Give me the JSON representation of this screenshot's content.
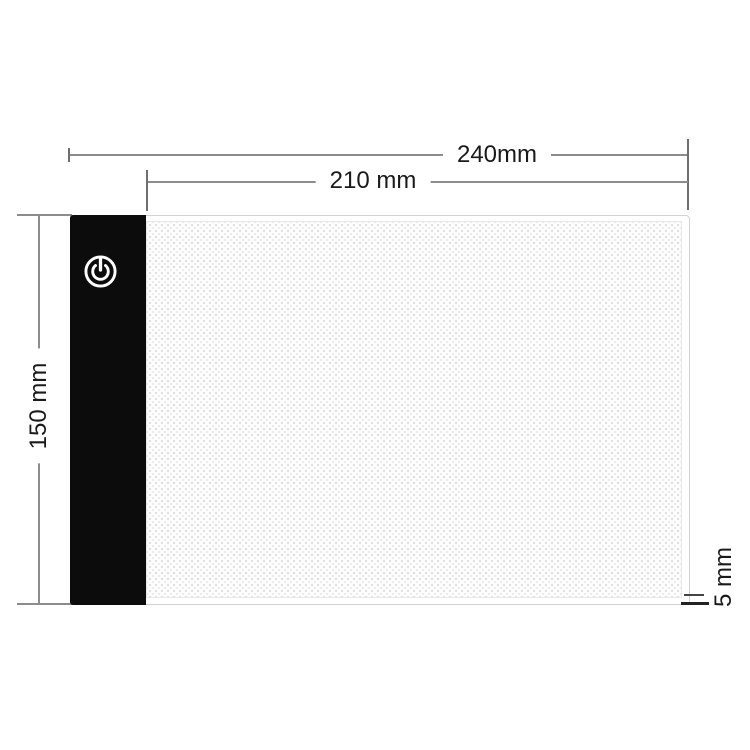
{
  "diagram": {
    "title": "light-pad-dimension-diagram",
    "dimensions": {
      "overall_width": {
        "value": 240,
        "unit": "mm",
        "label": "240mm"
      },
      "surface_width": {
        "value": 210,
        "unit": "mm",
        "label": "210 mm"
      },
      "height": {
        "value": 150,
        "unit": "mm",
        "label": "150 mm"
      },
      "thickness": {
        "value": 5,
        "unit": "mm",
        "label": "5 mm"
      }
    },
    "icons": {
      "power": "power-icon"
    },
    "colors": {
      "background": "#ffffff",
      "strip": "#0c0c0c",
      "icon": "#ffffff",
      "dimension_line": "#8c8c8c",
      "text": "#1a1a1a",
      "pad_border": "#d2d2d2",
      "surface_dot": "#dedede"
    }
  }
}
